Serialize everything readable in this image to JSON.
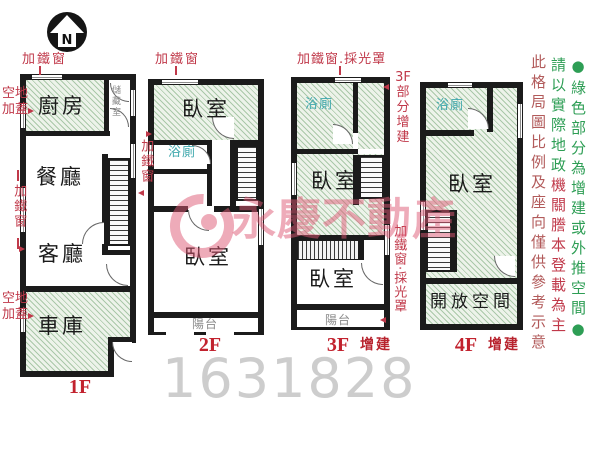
{
  "compass": {
    "letter": "N"
  },
  "watermark": {
    "brand": "永慶不動產",
    "listing_number": "1631828"
  },
  "annotations": {
    "f1_window_top": "加鐵窗",
    "f1_vacant_top": "空地\n加蓋",
    "f1_window_left": "加鐵窗",
    "f1_vacant_bottom": "空地\n加蓋",
    "f12_window_mid": "加鐵窗",
    "f2_window_top": "加鐵窗",
    "f3_window_top": "加鐵窗.採光罩",
    "f3_partial_add": "3F\n部\n分\n增\n建",
    "f3_window_right": "加鐵窗‧採光罩"
  },
  "floors": {
    "f1": {
      "label": "1F",
      "kitchen": "廚房",
      "storage": "儲藏室",
      "dining": "餐廳",
      "living": "客廳",
      "garage": "車庫"
    },
    "f2": {
      "label": "2F",
      "bedroom_top": "臥室",
      "bath": "浴廁",
      "bedroom_main": "臥室",
      "balcony": "陽台"
    },
    "f3": {
      "label": "3F",
      "suffix": "增建",
      "bath": "浴廁",
      "bedroom_top": "臥室",
      "bedroom_low": "臥室",
      "balcony": "陽台"
    },
    "f4": {
      "label": "4F",
      "suffix": "增建",
      "bath": "浴廁",
      "bedroom": "臥室",
      "open_space": "開放空間"
    }
  },
  "notes": {
    "green_area_note": "●綠色部分為增建或外推空間●",
    "disclaimer_registry_green": "請以實際地政",
    "disclaimer_registry_red": "機關謄本登載為主",
    "disclaimer_scale": "此格局圖比例及座向僅供參考示意"
  },
  "colors": {
    "wall": "#1b1b1b",
    "hatch_green": "#edf3ea",
    "annotation_red": "#c0394a",
    "note_green": "#2e9e55",
    "disclaimer_red": "#b25b5b",
    "bath_teal": "#3fa8ad",
    "watermark_pink": "#dd5873"
  }
}
